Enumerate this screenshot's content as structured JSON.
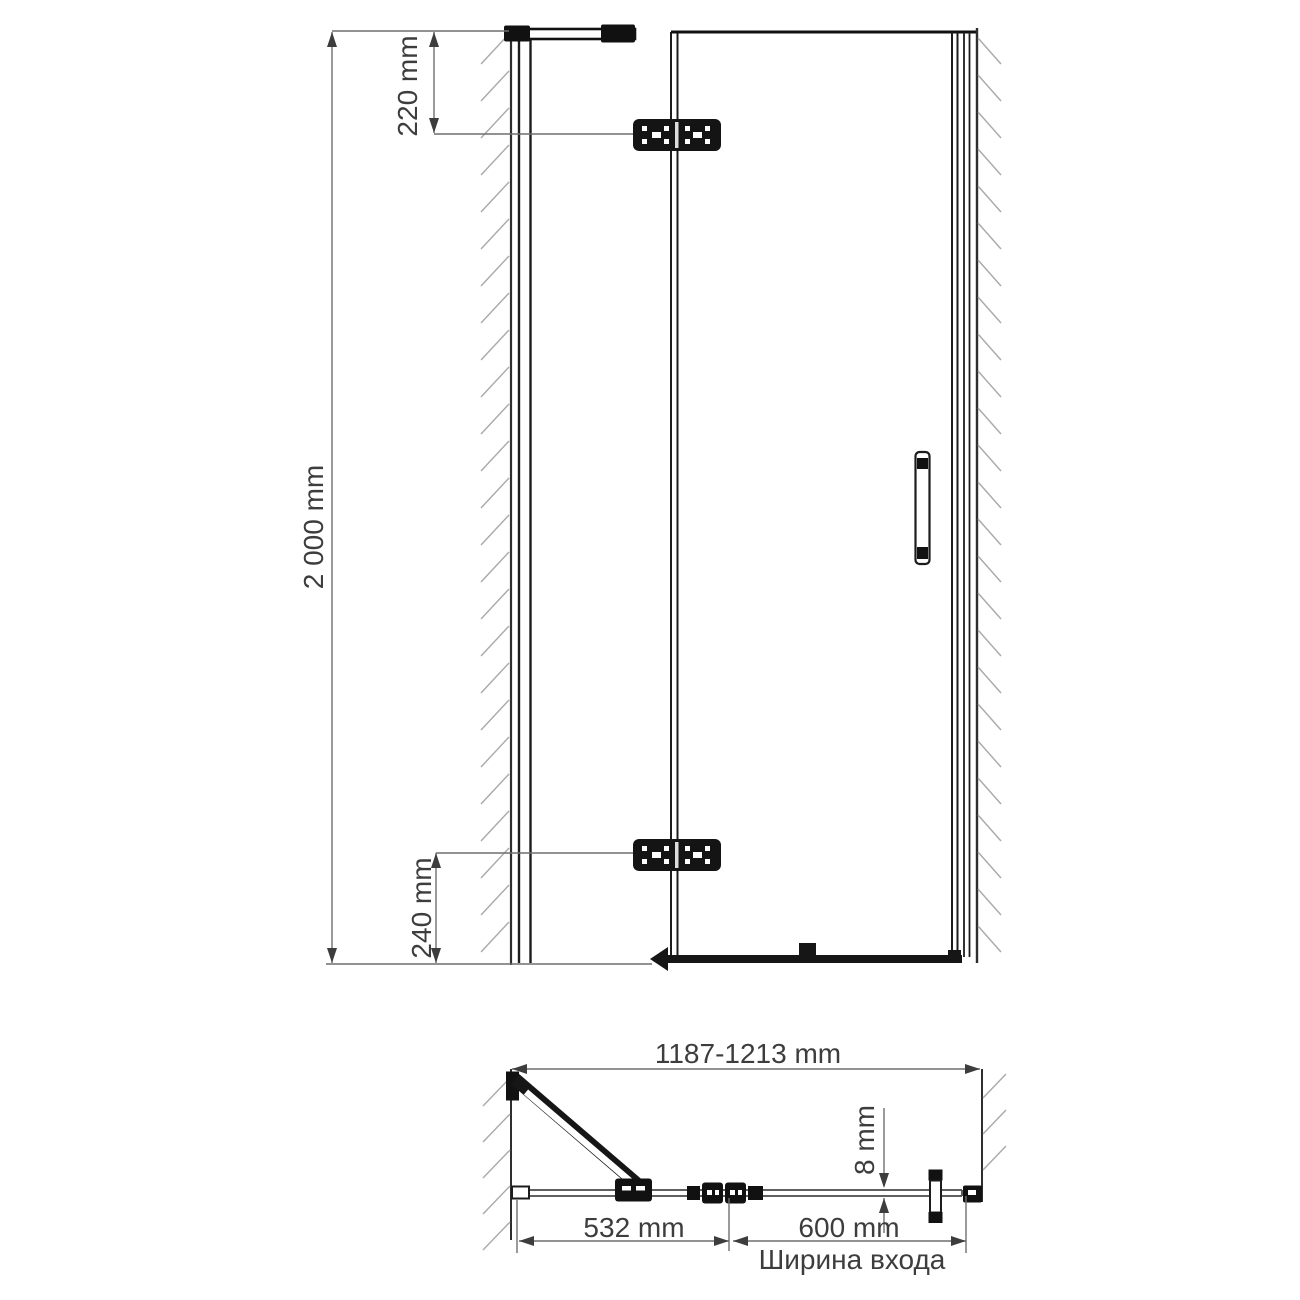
{
  "drawing": {
    "title": "shower-door-dimension-drawing",
    "front_view": {
      "height_label": "2 000 mm",
      "top_hinge_offset_label": "220 mm",
      "bottom_hinge_offset_label": "240 mm"
    },
    "plan_view": {
      "overall_width_label": "1187-1213 mm",
      "fixed_panel_width_label": "532 mm",
      "door_width_label": "600 mm",
      "glass_thickness_label": "8 mm",
      "entrance_width_caption": "Ширина входа"
    },
    "colors": {
      "structure": "#1c1c1c",
      "frame": "#2e2e2e",
      "dimension": "#6f6f6f",
      "hatch": "#a9a9a9",
      "text": "#3d3d3d"
    }
  }
}
